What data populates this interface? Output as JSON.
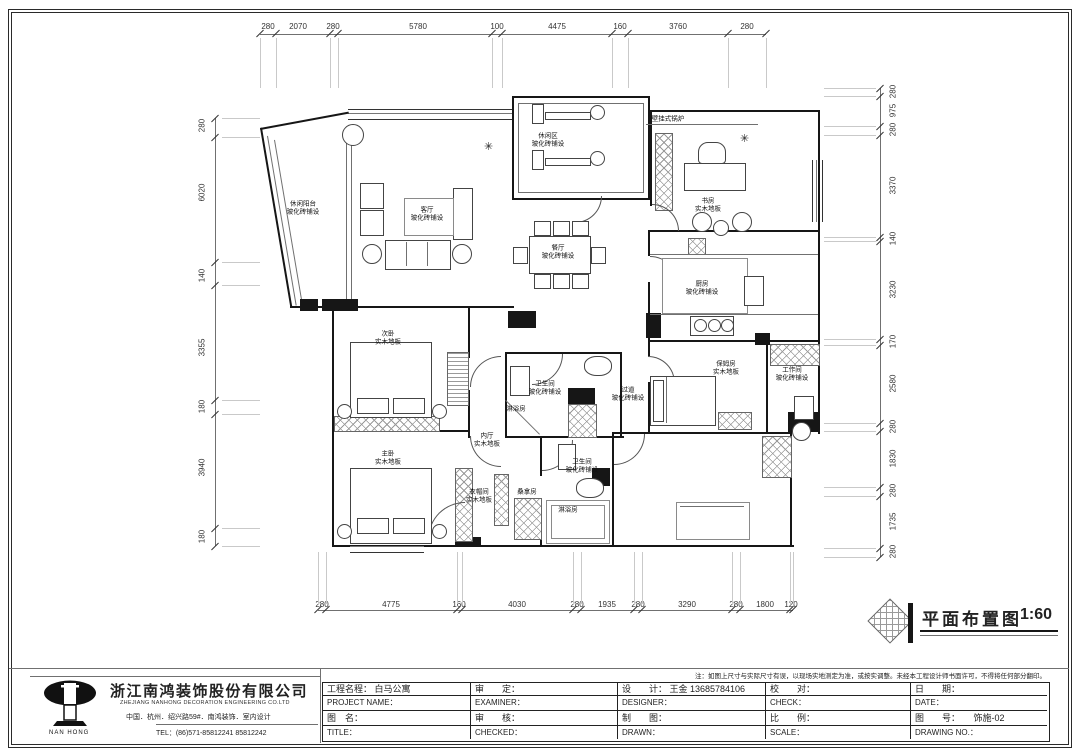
{
  "sheet": {
    "stamp_title": "平面布置图",
    "stamp_scale": "1:60",
    "note": "注：如图上尺寸与实际尺寸有误，以现场实地测定为准，或按实调整。未经本工程设计师书面许可，不得将任何部分翻印。"
  },
  "company": {
    "logo_text": "NAN HONG",
    "name_cn": "浙江南鸿装饰股份有限公司",
    "name_en": "ZHEJIANG NANHONG DECORATION ENGINEERING CO.LTD",
    "address": "中国．杭州．绍兴路59#．南鸿装饰．室内设计",
    "tel": "TEL：(86)571-85812241  85812242"
  },
  "titleblock": {
    "rows": [
      [
        "工程名程： 白马公寓",
        "审　　定：",
        "设　　计： 王金  13685784106",
        "校　　对：",
        "日　　期："
      ],
      [
        "PROJECT NAME：",
        "EXAMINER：",
        "DESIGNER：",
        "CHECK：",
        "DATE："
      ],
      [
        "图　名：",
        "审　　核：",
        "制　　图：",
        "比　　例：",
        "图　　号：　　饰施-02"
      ],
      [
        "TITLE：",
        "CHECKED：",
        "DRAWN：",
        "SCALE：",
        "DRAWING NO.："
      ]
    ]
  },
  "dims": {
    "top": {
      "items": [
        {
          "v": "280",
          "c": 268
        },
        {
          "v": "2070",
          "c": 298
        },
        {
          "v": "280",
          "c": 333
        },
        {
          "v": "5780",
          "c": 418
        },
        {
          "v": "100",
          "c": 497
        },
        {
          "v": "4475",
          "c": 557
        },
        {
          "v": "160",
          "c": 620
        },
        {
          "v": "3760",
          "c": 678
        },
        {
          "v": "280",
          "c": 747
        }
      ],
      "bounds": [
        260,
        276,
        330,
        338,
        492,
        502,
        612,
        628,
        728,
        766
      ]
    },
    "bottom": {
      "items": [
        {
          "v": "280",
          "c": 322
        },
        {
          "v": "4775",
          "c": 391
        },
        {
          "v": "160",
          "c": 459
        },
        {
          "v": "4030",
          "c": 517
        },
        {
          "v": "280",
          "c": 577
        },
        {
          "v": "1935",
          "c": 607
        },
        {
          "v": "280",
          "c": 638
        },
        {
          "v": "3290",
          "c": 687
        },
        {
          "v": "280",
          "c": 736
        },
        {
          "v": "1800",
          "c": 765
        },
        {
          "v": "120",
          "c": 791
        }
      ],
      "bounds": [
        318,
        326,
        457,
        462,
        573,
        581,
        634,
        642,
        732,
        740,
        790,
        793
      ]
    },
    "left": {
      "items": [
        {
          "v": "280",
          "c": 126
        },
        {
          "v": "6020",
          "c": 193
        },
        {
          "v": "140",
          "c": 276
        },
        {
          "v": "3355",
          "c": 348
        },
        {
          "v": "180",
          "c": 407
        },
        {
          "v": "3940",
          "c": 468
        },
        {
          "v": "180",
          "c": 537
        }
      ],
      "bounds": [
        118,
        137,
        262,
        285,
        400,
        414,
        528,
        546
      ]
    },
    "right": {
      "items": [
        {
          "v": "280",
          "c": 92
        },
        {
          "v": "975",
          "c": 111
        },
        {
          "v": "280",
          "c": 130
        },
        {
          "v": "3370",
          "c": 186
        },
        {
          "v": "140",
          "c": 239
        },
        {
          "v": "3230",
          "c": 290
        },
        {
          "v": "170",
          "c": 342
        },
        {
          "v": "2580",
          "c": 384
        },
        {
          "v": "280",
          "c": 427
        },
        {
          "v": "1830",
          "c": 459
        },
        {
          "v": "280",
          "c": 491
        },
        {
          "v": "1735",
          "c": 522
        },
        {
          "v": "280",
          "c": 552
        }
      ],
      "bounds": [
        88,
        96,
        126,
        135,
        237,
        241,
        339,
        345,
        423,
        431,
        487,
        496,
        548,
        557
      ]
    }
  },
  "rooms": [
    {
      "name": "休闲区",
      "floor": "玻化砖铺设",
      "x": 548,
      "y": 140
    },
    {
      "name": "休闲阳台",
      "floor": "玻化砖铺设",
      "x": 303,
      "y": 208
    },
    {
      "name": "客厅",
      "floor": "玻化砖铺设",
      "x": 427,
      "y": 214
    },
    {
      "name": "餐厅",
      "floor": "玻化砖铺设",
      "x": 558,
      "y": 252
    },
    {
      "name": "书房",
      "floor": "实木地板",
      "x": 708,
      "y": 205
    },
    {
      "name": "厨房",
      "floor": "玻化砖铺设",
      "x": 702,
      "y": 288
    },
    {
      "name": "保姆房",
      "floor": "实木地板",
      "x": 726,
      "y": 368
    },
    {
      "name": "工作间",
      "floor": "玻化砖铺设",
      "x": 792,
      "y": 374
    },
    {
      "name": "次卧",
      "floor": "实木地板",
      "x": 388,
      "y": 338
    },
    {
      "name": "主卧",
      "floor": "实木地板",
      "x": 388,
      "y": 458
    },
    {
      "name": "内厅",
      "floor": "实木地板",
      "x": 487,
      "y": 440
    },
    {
      "name": "衣帽间",
      "floor": "实木地板",
      "x": 479,
      "y": 496
    },
    {
      "name": "卫生间",
      "floor": "玻化砖铺设",
      "x": 545,
      "y": 388
    },
    {
      "name": "卫生间",
      "floor": "玻化砖铺设",
      "x": 582,
      "y": 466
    },
    {
      "name": "过道",
      "floor": "玻化砖铺设",
      "x": 628,
      "y": 394
    },
    {
      "name": "桑拿房",
      "x": 527,
      "y": 492
    },
    {
      "name": "淋浴房",
      "x": 568,
      "y": 510
    },
    {
      "name": "淋浴房",
      "x": 516,
      "y": 409
    }
  ],
  "annotations": [
    {
      "text": "壁挂式锅炉",
      "x": 668,
      "y": 119
    }
  ]
}
